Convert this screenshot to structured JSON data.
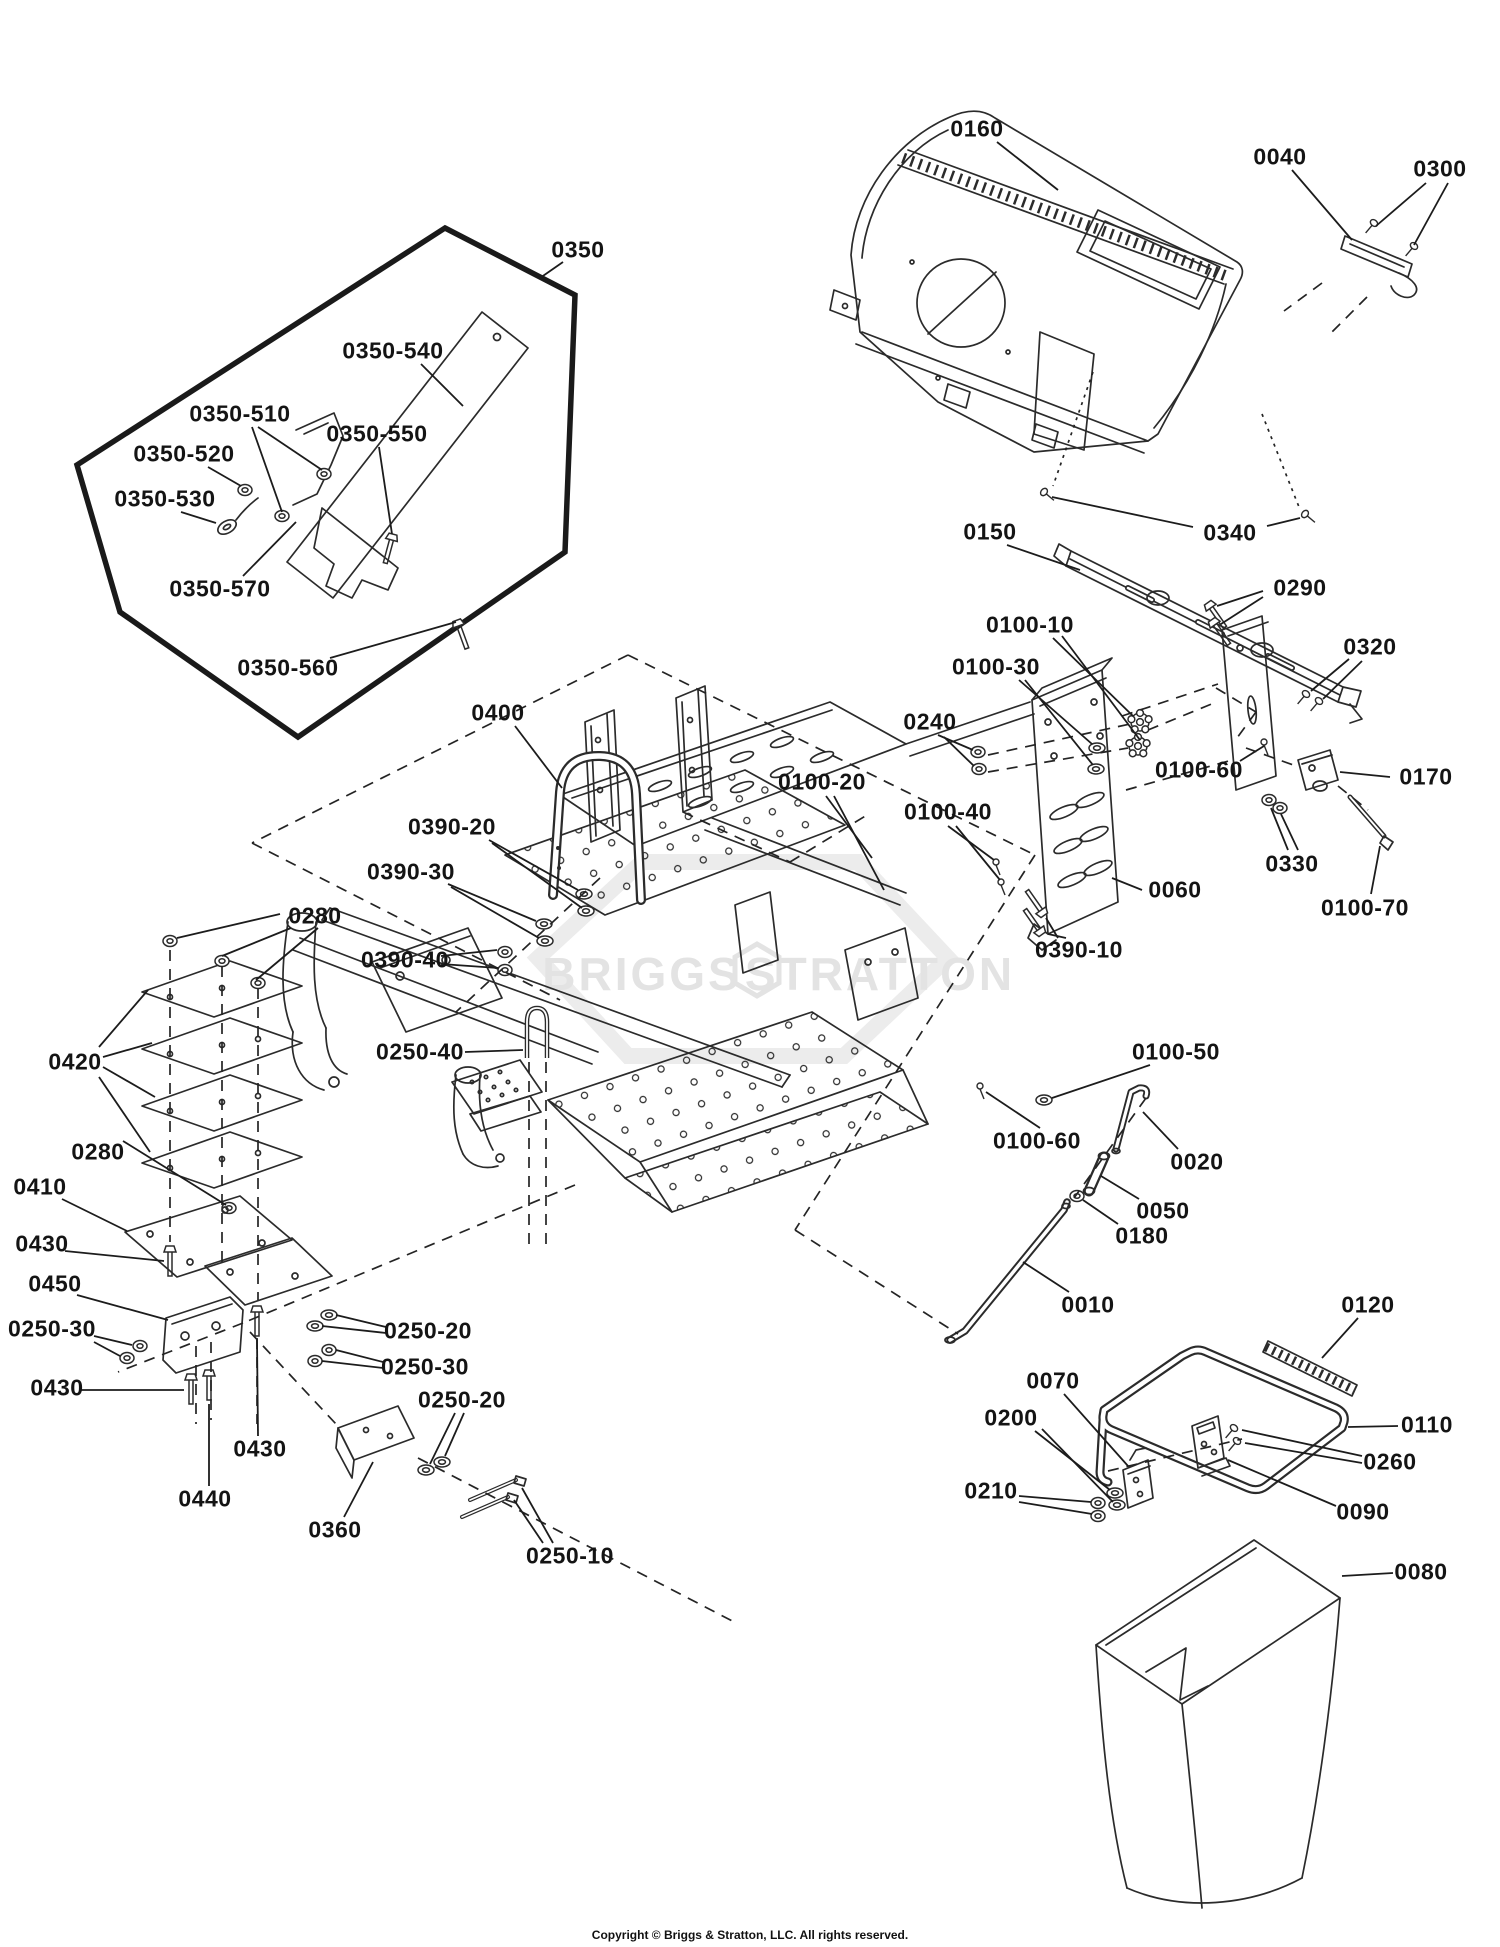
{
  "watermark": {
    "left": "BRIGGS",
    "right": "STRATTON"
  },
  "footer": {
    "copyright": "Copyright © Briggs & Stratton, LLC. All rights reserved."
  },
  "callouts": [
    {
      "id": "0160",
      "label": "0160",
      "x": 977,
      "y": 129,
      "leaders": [
        [
          997,
          142,
          1058,
          190
        ]
      ]
    },
    {
      "id": "0040",
      "label": "0040",
      "x": 1280,
      "y": 157,
      "leaders": [
        [
          1292,
          170,
          1352,
          240
        ]
      ]
    },
    {
      "id": "0300",
      "label": "0300",
      "x": 1440,
      "y": 169,
      "leaders": [
        [
          1426,
          183,
          1376,
          226
        ],
        [
          1448,
          183,
          1414,
          245
        ]
      ]
    },
    {
      "id": "0340",
      "label": "0340",
      "x": 1230,
      "y": 533,
      "leaders": [
        [
          1193,
          527,
          1052,
          497
        ],
        [
          1267,
          526,
          1300,
          518
        ]
      ]
    },
    {
      "id": "0350",
      "label": "0350",
      "x": 578,
      "y": 250,
      "leaders": [
        [
          563,
          262,
          540,
          278
        ]
      ]
    },
    {
      "id": "0350-540",
      "label": "0350-540",
      "x": 393,
      "y": 351,
      "leaders": [
        [
          421,
          364,
          463,
          406
        ]
      ]
    },
    {
      "id": "0350-510",
      "label": "0350-510",
      "x": 240,
      "y": 414,
      "leaders": [
        [
          258,
          427,
          322,
          470
        ],
        [
          252,
          427,
          282,
          512
        ]
      ]
    },
    {
      "id": "0350-550",
      "label": "0350-550",
      "x": 377,
      "y": 434,
      "leaders": [
        [
          379,
          447,
          392,
          534
        ]
      ]
    },
    {
      "id": "0350-520",
      "label": "0350-520",
      "x": 184,
      "y": 454,
      "leaders": [
        [
          208,
          467,
          241,
          486
        ]
      ]
    },
    {
      "id": "0350-530",
      "label": "0350-530",
      "x": 165,
      "y": 499,
      "leaders": [
        [
          181,
          512,
          216,
          523
        ]
      ]
    },
    {
      "id": "0350-570",
      "label": "0350-570",
      "x": 220,
      "y": 589,
      "leaders": [
        [
          243,
          576,
          296,
          522
        ]
      ]
    },
    {
      "id": "0350-560",
      "label": "0350-560",
      "x": 288,
      "y": 668,
      "leaders": [
        [
          330,
          658,
          456,
          622
        ]
      ]
    },
    {
      "id": "0150",
      "label": "0150",
      "x": 990,
      "y": 532,
      "leaders": [
        [
          1007,
          545,
          1080,
          570
        ]
      ]
    },
    {
      "id": "0290",
      "label": "0290",
      "x": 1300,
      "y": 588,
      "leaders": [
        [
          1263,
          591,
          1217,
          606
        ],
        [
          1263,
          597,
          1221,
          624
        ]
      ]
    },
    {
      "id": "0320",
      "label": "0320",
      "x": 1370,
      "y": 647,
      "leaders": [
        [
          1349,
          659,
          1311,
          691
        ],
        [
          1362,
          661,
          1323,
          699
        ]
      ]
    },
    {
      "id": "0100-10",
      "label": "0100-10",
      "x": 1030,
      "y": 625,
      "leaders": [
        [
          1053,
          638,
          1133,
          716
        ],
        [
          1062,
          636,
          1140,
          740
        ]
      ]
    },
    {
      "id": "0100-30",
      "label": "0100-30",
      "x": 996,
      "y": 667,
      "leaders": [
        [
          1019,
          680,
          1092,
          744
        ],
        [
          1025,
          680,
          1093,
          765
        ]
      ]
    },
    {
      "id": "0240",
      "label": "0240",
      "x": 930,
      "y": 722,
      "leaders": [
        [
          938,
          735,
          973,
          750
        ],
        [
          944,
          737,
          974,
          766
        ]
      ]
    },
    {
      "id": "0100-20",
      "label": "0100-20",
      "x": 822,
      "y": 782,
      "leaders": [
        [
          826,
          796,
          872,
          858
        ],
        [
          834,
          796,
          884,
          890
        ]
      ]
    },
    {
      "id": "0100-40",
      "label": "0100-40",
      "x": 948,
      "y": 812,
      "leaders": [
        [
          948,
          826,
          994,
          860
        ],
        [
          956,
          826,
          1000,
          880
        ]
      ]
    },
    {
      "id": "0100-60-upper",
      "label": "0100-60",
      "x": 1199,
      "y": 770,
      "leaders": [
        [
          1240,
          761,
          1264,
          746
        ]
      ]
    },
    {
      "id": "0170",
      "label": "0170",
      "x": 1426,
      "y": 777,
      "leaders": [
        [
          1390,
          777,
          1340,
          772
        ]
      ]
    },
    {
      "id": "0330",
      "label": "0330",
      "x": 1292,
      "y": 864,
      "leaders": [
        [
          1288,
          850,
          1271,
          808
        ],
        [
          1298,
          850,
          1281,
          814
        ]
      ]
    },
    {
      "id": "0100-70",
      "label": "0100-70",
      "x": 1365,
      "y": 908,
      "leaders": [
        [
          1371,
          894,
          1380,
          846
        ]
      ]
    },
    {
      "id": "0060",
      "label": "0060",
      "x": 1175,
      "y": 890,
      "leaders": [
        [
          1142,
          890,
          1112,
          878
        ]
      ]
    },
    {
      "id": "0390-10",
      "label": "0390-10",
      "x": 1079,
      "y": 950,
      "leaders": [
        [
          1058,
          938,
          1046,
          918
        ],
        [
          1066,
          938,
          1048,
          934
        ]
      ]
    },
    {
      "id": "0400",
      "label": "0400",
      "x": 498,
      "y": 713,
      "leaders": [
        [
          515,
          726,
          562,
          788
        ]
      ]
    },
    {
      "id": "0390-20",
      "label": "0390-20",
      "x": 452,
      "y": 827,
      "leaders": [
        [
          489,
          840,
          578,
          890
        ],
        [
          492,
          843,
          582,
          908
        ]
      ]
    },
    {
      "id": "0390-30",
      "label": "0390-30",
      "x": 411,
      "y": 872,
      "leaders": [
        [
          448,
          884,
          536,
          921
        ],
        [
          451,
          887,
          539,
          938
        ]
      ]
    },
    {
      "id": "0390-40",
      "label": "0390-40",
      "x": 405,
      "y": 960,
      "leaders": [
        [
          441,
          956,
          497,
          950
        ],
        [
          441,
          964,
          498,
          968
        ]
      ]
    },
    {
      "id": "0280-upper",
      "label": "0280",
      "x": 315,
      "y": 916,
      "leaders": [
        [
          280,
          914,
          177,
          938
        ],
        [
          291,
          928,
          222,
          956
        ],
        [
          318,
          928,
          256,
          980
        ]
      ]
    },
    {
      "id": "0420",
      "label": "0420",
      "x": 75,
      "y": 1062,
      "leaders": [
        [
          99,
          1047,
          148,
          990
        ],
        [
          103,
          1057,
          152,
          1043
        ],
        [
          103,
          1067,
          155,
          1097
        ],
        [
          99,
          1077,
          150,
          1152
        ]
      ]
    },
    {
      "id": "0250-40",
      "label": "0250-40",
      "x": 420,
      "y": 1052,
      "leaders": [
        [
          465,
          1052,
          523,
          1050
        ]
      ]
    },
    {
      "id": "0280-lower",
      "label": "0280",
      "x": 98,
      "y": 1152,
      "leaders": [
        [
          123,
          1141,
          226,
          1205
        ]
      ]
    },
    {
      "id": "0410",
      "label": "0410",
      "x": 40,
      "y": 1187,
      "leaders": [
        [
          62,
          1199,
          127,
          1231
        ]
      ]
    },
    {
      "id": "0430-a",
      "label": "0430",
      "x": 42,
      "y": 1244,
      "leaders": [
        [
          65,
          1251,
          164,
          1261
        ]
      ]
    },
    {
      "id": "0450",
      "label": "0450",
      "x": 55,
      "y": 1284,
      "leaders": [
        [
          77,
          1295,
          168,
          1320
        ]
      ]
    },
    {
      "id": "0250-30-a",
      "label": "0250-30",
      "x": 52,
      "y": 1329,
      "leaders": [
        [
          94,
          1336,
          132,
          1345
        ],
        [
          94,
          1342,
          120,
          1356
        ]
      ]
    },
    {
      "id": "0430-b",
      "label": "0430",
      "x": 57,
      "y": 1388,
      "leaders": [
        [
          80,
          1390,
          184,
          1390
        ]
      ]
    },
    {
      "id": "0250-20-a",
      "label": "0250-20",
      "x": 428,
      "y": 1331,
      "leaders": [
        [
          386,
          1327,
          336,
          1315
        ],
        [
          386,
          1333,
          322,
          1326
        ]
      ]
    },
    {
      "id": "0250-30-b",
      "label": "0250-30",
      "x": 425,
      "y": 1367,
      "leaders": [
        [
          383,
          1362,
          336,
          1350
        ],
        [
          383,
          1368,
          322,
          1361
        ]
      ]
    },
    {
      "id": "0250-20-b",
      "label": "0250-20",
      "x": 462,
      "y": 1400,
      "leaders": [
        [
          455,
          1413,
          430,
          1464
        ],
        [
          464,
          1413,
          445,
          1456
        ]
      ]
    },
    {
      "id": "0430-c",
      "label": "0430",
      "x": 260,
      "y": 1449,
      "leaders": [
        [
          258,
          1436,
          257,
          1340
        ]
      ]
    },
    {
      "id": "0440",
      "label": "0440",
      "x": 205,
      "y": 1499,
      "leaders": [
        [
          209,
          1486,
          209,
          1404
        ]
      ]
    },
    {
      "id": "0360",
      "label": "0360",
      "x": 335,
      "y": 1530,
      "leaders": [
        [
          344,
          1517,
          373,
          1462
        ]
      ]
    },
    {
      "id": "0250-10",
      "label": "0250-10",
      "x": 570,
      "y": 1556,
      "leaders": [
        [
          543,
          1543,
          514,
          1500
        ],
        [
          553,
          1543,
          522,
          1488
        ]
      ]
    },
    {
      "id": "0100-50",
      "label": "0100-50",
      "x": 1176,
      "y": 1052,
      "leaders": [
        [
          1150,
          1065,
          1052,
          1098
        ]
      ]
    },
    {
      "id": "0100-60-lower",
      "label": "0100-60",
      "x": 1037,
      "y": 1141,
      "leaders": [
        [
          1040,
          1128,
          986,
          1092
        ]
      ]
    },
    {
      "id": "0020",
      "label": "0020",
      "x": 1197,
      "y": 1162,
      "leaders": [
        [
          1178,
          1149,
          1143,
          1112
        ]
      ]
    },
    {
      "id": "0050",
      "label": "0050",
      "x": 1163,
      "y": 1211,
      "leaders": [
        [
          1139,
          1199,
          1101,
          1176
        ]
      ]
    },
    {
      "id": "0180",
      "label": "0180",
      "x": 1142,
      "y": 1236,
      "leaders": [
        [
          1118,
          1224,
          1083,
          1200
        ]
      ]
    },
    {
      "id": "0010",
      "label": "0010",
      "x": 1088,
      "y": 1305,
      "leaders": [
        [
          1069,
          1292,
          1023,
          1262
        ]
      ]
    },
    {
      "id": "0120",
      "label": "0120",
      "x": 1368,
      "y": 1305,
      "leaders": [
        [
          1358,
          1318,
          1322,
          1358
        ]
      ]
    },
    {
      "id": "0070",
      "label": "0070",
      "x": 1053,
      "y": 1381,
      "leaders": [
        [
          1064,
          1394,
          1128,
          1466
        ]
      ]
    },
    {
      "id": "0200",
      "label": "0200",
      "x": 1011,
      "y": 1418,
      "leaders": [
        [
          1035,
          1431,
          1110,
          1490
        ],
        [
          1042,
          1429,
          1113,
          1502
        ]
      ]
    },
    {
      "id": "0210",
      "label": "0210",
      "x": 991,
      "y": 1491,
      "leaders": [
        [
          1019,
          1496,
          1091,
          1502
        ],
        [
          1019,
          1502,
          1092,
          1514
        ]
      ]
    },
    {
      "id": "0110",
      "label": "0110",
      "x": 1427,
      "y": 1425,
      "leaders": [
        [
          1398,
          1426,
          1348,
          1427
        ]
      ]
    },
    {
      "id": "0260",
      "label": "0260",
      "x": 1390,
      "y": 1462,
      "leaders": [
        [
          1362,
          1456,
          1242,
          1430
        ],
        [
          1362,
          1463,
          1245,
          1443
        ]
      ]
    },
    {
      "id": "0090",
      "label": "0090",
      "x": 1363,
      "y": 1512,
      "leaders": [
        [
          1336,
          1506,
          1228,
          1460
        ]
      ]
    },
    {
      "id": "0080",
      "label": "0080",
      "x": 1421,
      "y": 1572,
      "leaders": [
        [
          1393,
          1573,
          1342,
          1576
        ]
      ]
    }
  ]
}
